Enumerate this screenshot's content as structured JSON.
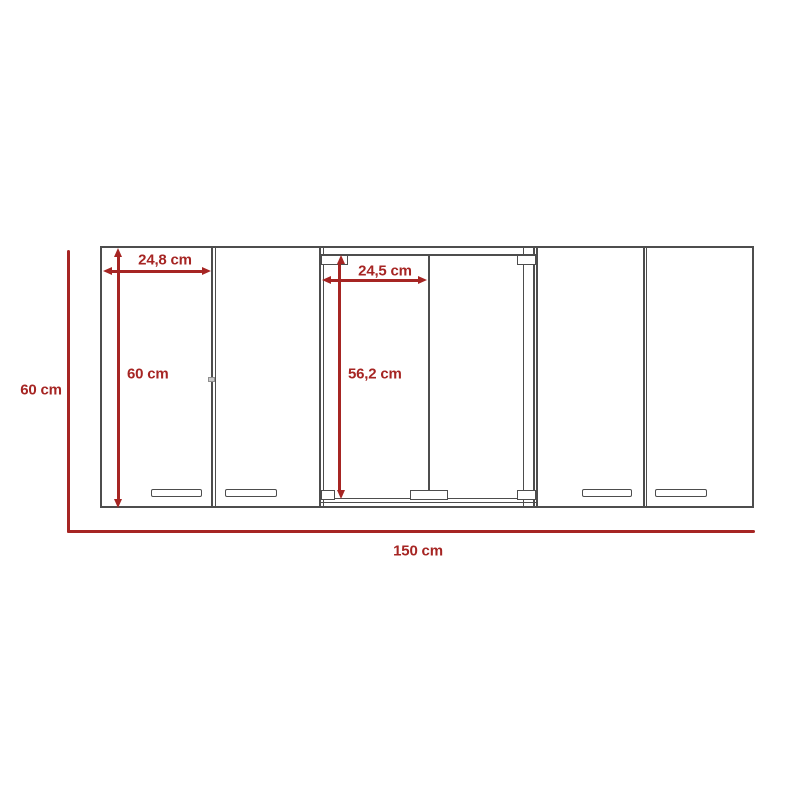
{
  "colors": {
    "dimension_red": "#a62523",
    "cabinet_outline_gray": "#4d4d4d",
    "background": "#ffffff"
  },
  "labels": {
    "left_door_width": "24,8 cm",
    "left_door_height": "60 cm",
    "glass_door_width": "24,5 cm",
    "glass_door_height": "56,2 cm",
    "overall_height": "60 cm",
    "overall_width": "150 cm"
  }
}
